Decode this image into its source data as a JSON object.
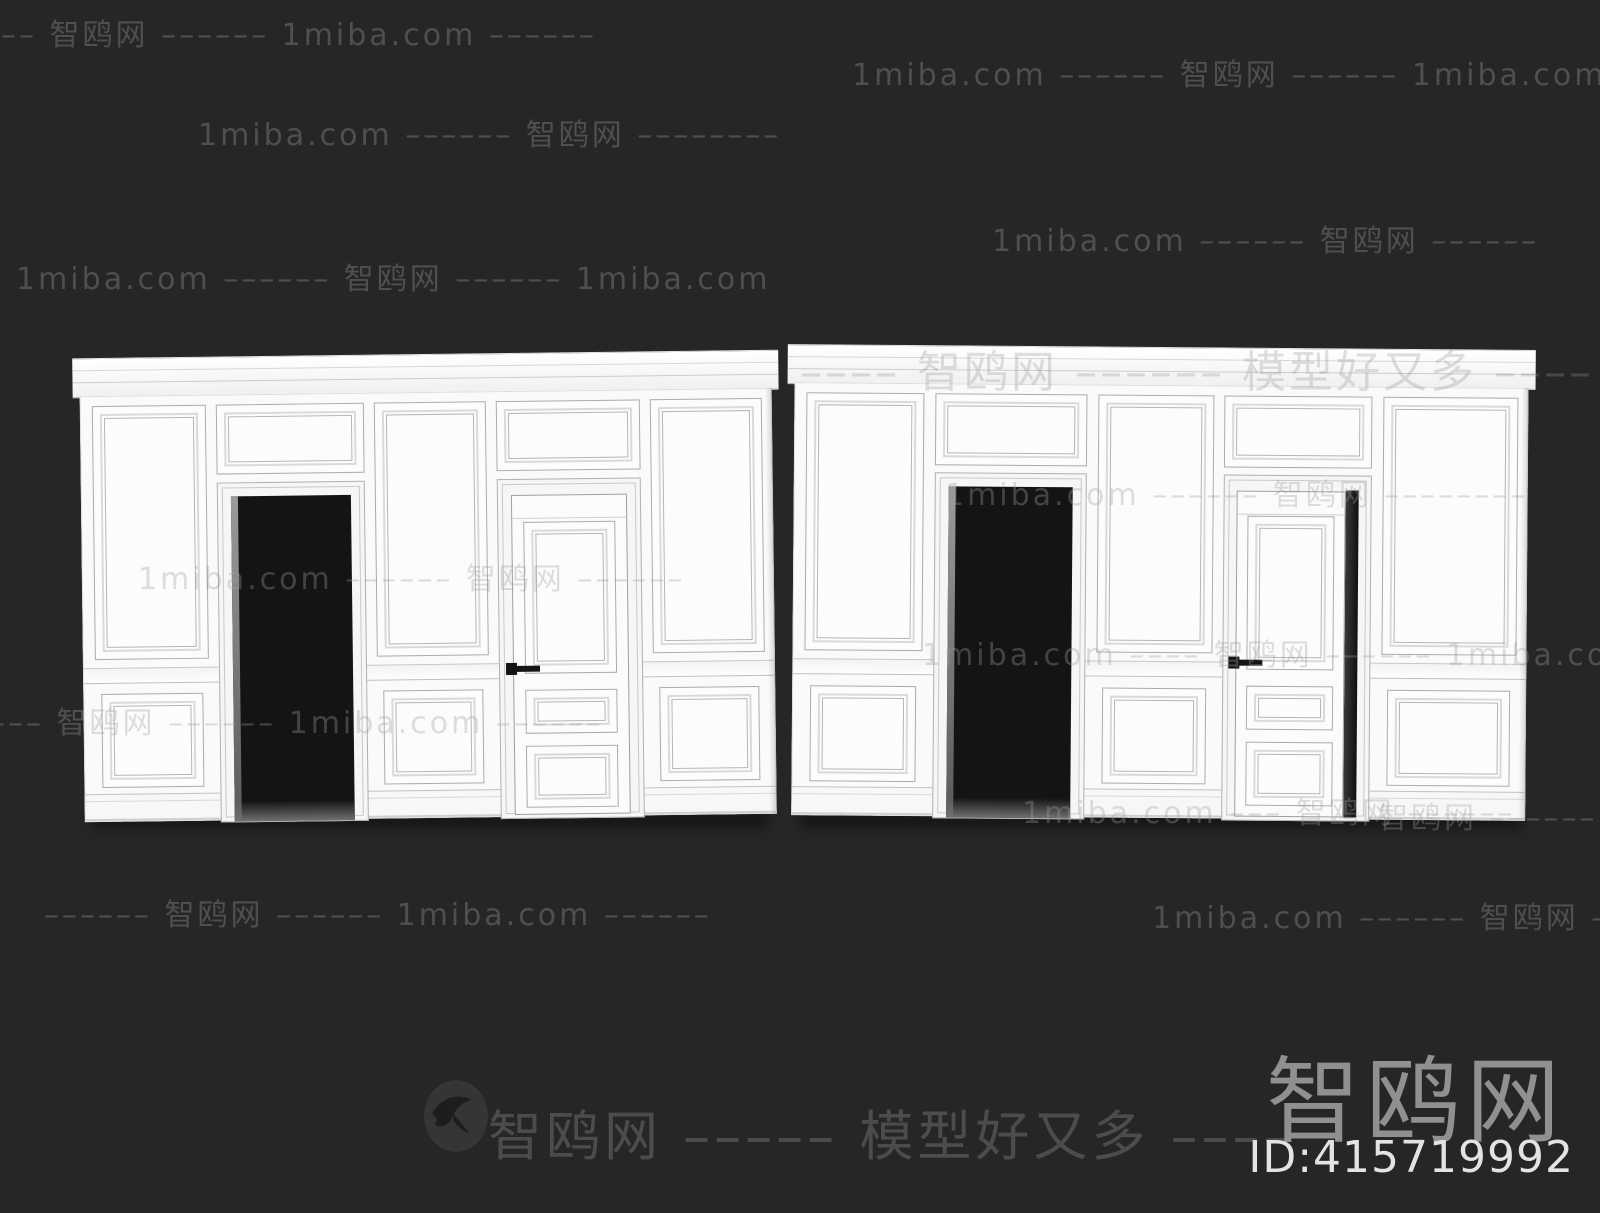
{
  "colors": {
    "background": "#262626",
    "wall": "#fafafa",
    "molding_line": "#b6b6b6",
    "doorway_opening": "#141414",
    "door_handle": "#141414",
    "watermark_gray": "#9e9e9e",
    "brand_gray": "#909090",
    "id_text": "#e3e3e3"
  },
  "watermarks": {
    "rows": [
      "–––– 智鸥网 –––––– 1miba.com ––––––",
      "1miba.com –––––– 智鸥网 –––––– 1miba.com",
      "1miba.com –––––– 智鸥网 ––––––––",
      "1miba.com –––––– 智鸥网 ––––––",
      "1miba.com –––––– 智鸥网 –––––– 1miba.com",
      "–––– 智鸥网 –––––– 模型好又多 ––––",
      "1miba.com –––––– 智鸥网 ––––––––",
      "1miba.com –––––– 智鸥网 ––––––",
      "1miba.com –––– 智鸥网 –––––– 1miba.com ––",
      "–––– 智鸥网 –––––– 1miba.com ––––––",
      "1miba.com ––– 智鸥网 ––––––",
      "智鸥网 ––––––",
      "–––––– 智鸥网 –––––– 1miba.com ––––––",
      "1miba.com –––––– 智鸥网 ––––––"
    ],
    "bottom_center_text": "智鸥网 ––––– 模型好又多 ––––",
    "bottom_center_icon": "seagull-icon",
    "brand_logo": "智鸥网",
    "model_id": "ID:415719992"
  }
}
